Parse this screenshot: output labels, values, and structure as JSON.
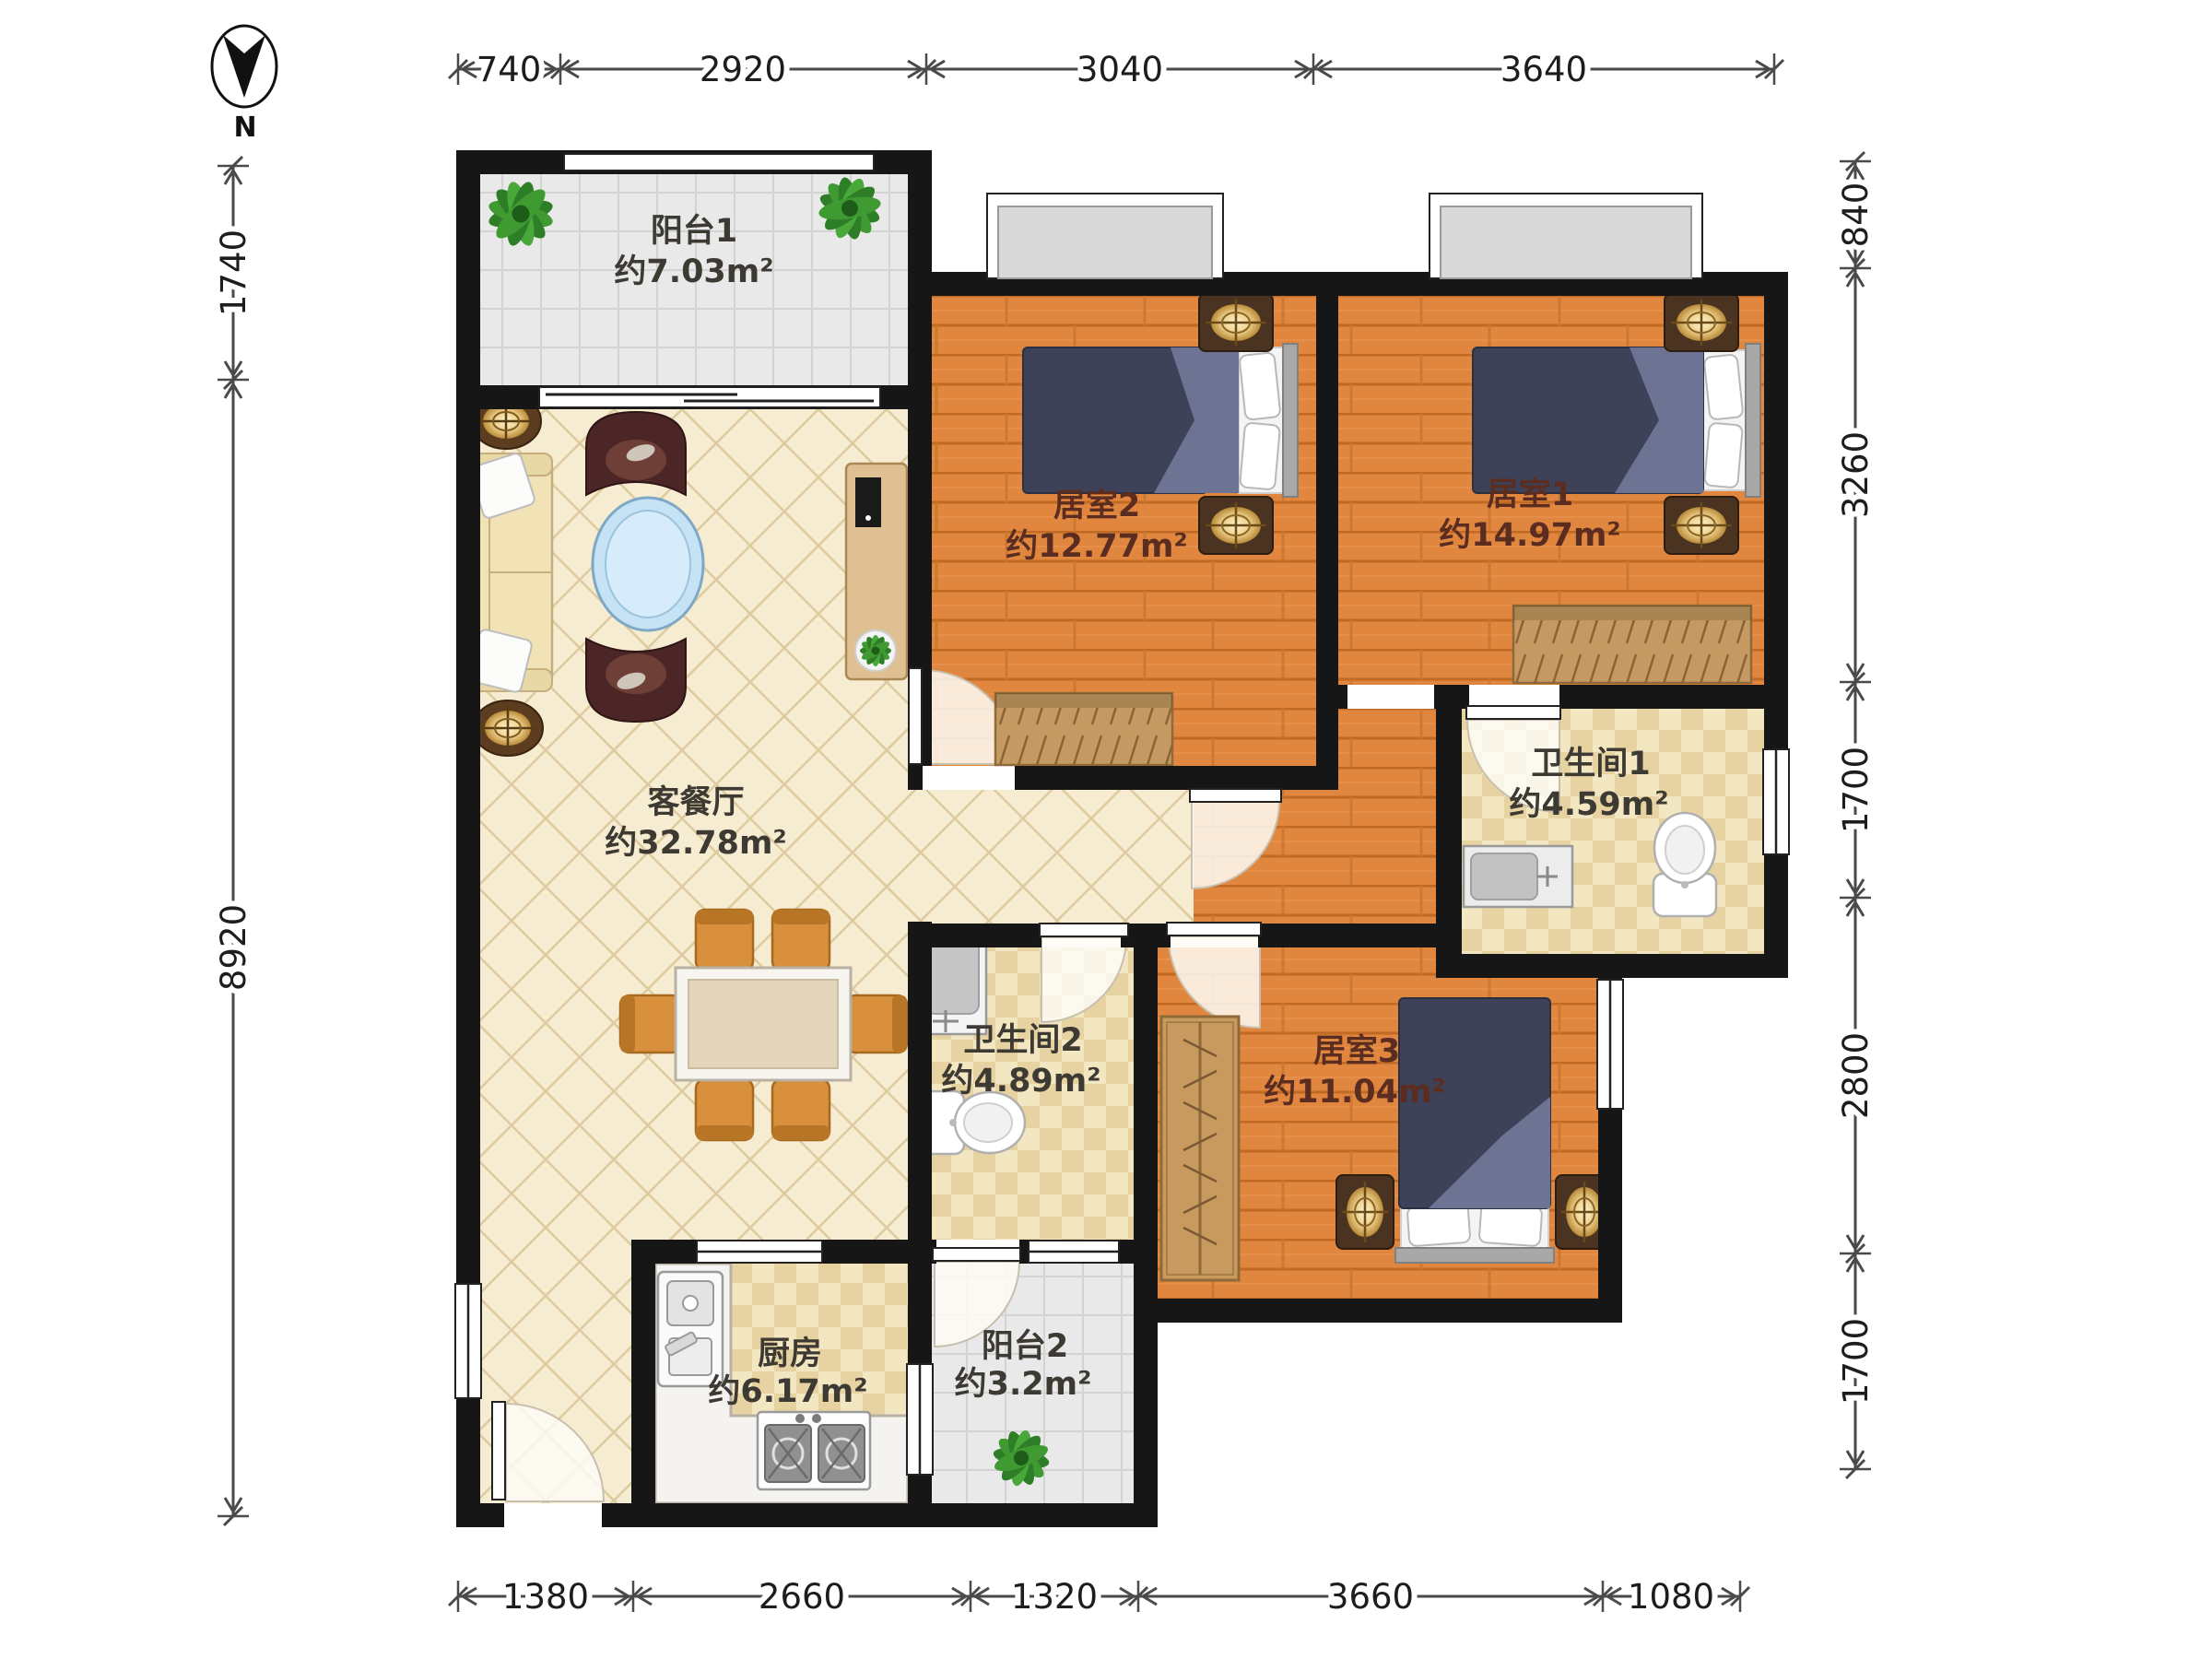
{
  "compass": {
    "label": "N"
  },
  "rooms": {
    "balcony1": {
      "name": "阳台1",
      "area": "约7.03m²"
    },
    "bedroom2": {
      "name": "居室2",
      "area": "约12.77m²"
    },
    "bedroom1": {
      "name": "居室1",
      "area": "约14.97m²"
    },
    "living": {
      "name": "客餐厅",
      "area": "约32.78m²"
    },
    "bath1": {
      "name": "卫生间1",
      "area": "约4.59m²"
    },
    "bath2": {
      "name": "卫生间2",
      "area": "约4.89m²"
    },
    "bedroom3": {
      "name": "居室3",
      "area": "约11.04m²"
    },
    "kitchen": {
      "name": "厨房",
      "area": "约6.17m²"
    },
    "balcony2": {
      "name": "阳台2",
      "area": "约3.2m²"
    }
  },
  "dimensions": {
    "top": [
      "740",
      "2920",
      "3040",
      "3640"
    ],
    "left": [
      "1740",
      "8920"
    ],
    "right": [
      "840",
      "3260",
      "1700",
      "2800",
      "1700"
    ],
    "bottom": [
      "1380",
      "2660",
      "1320",
      "3660",
      "1080"
    ]
  },
  "colors": {
    "wall": "#161616",
    "wood_floor": "#e0863e",
    "living_tile": "#f6ecd1",
    "bath_tile": "#f3e7c2",
    "balcony_tile": "#e9e9e9",
    "bed_blanket": "#3d4258",
    "bed_fold": "#6d7392",
    "furniture_wood": "#c89a60",
    "lamp_glow": "#edd08a",
    "coffee_table": "#c5e3f5",
    "plant_green": "#2e7d27",
    "label_dark": "#3d3a33",
    "label_bedroom": "#5b2d20",
    "dimension_line": "#4a4a4a"
  }
}
